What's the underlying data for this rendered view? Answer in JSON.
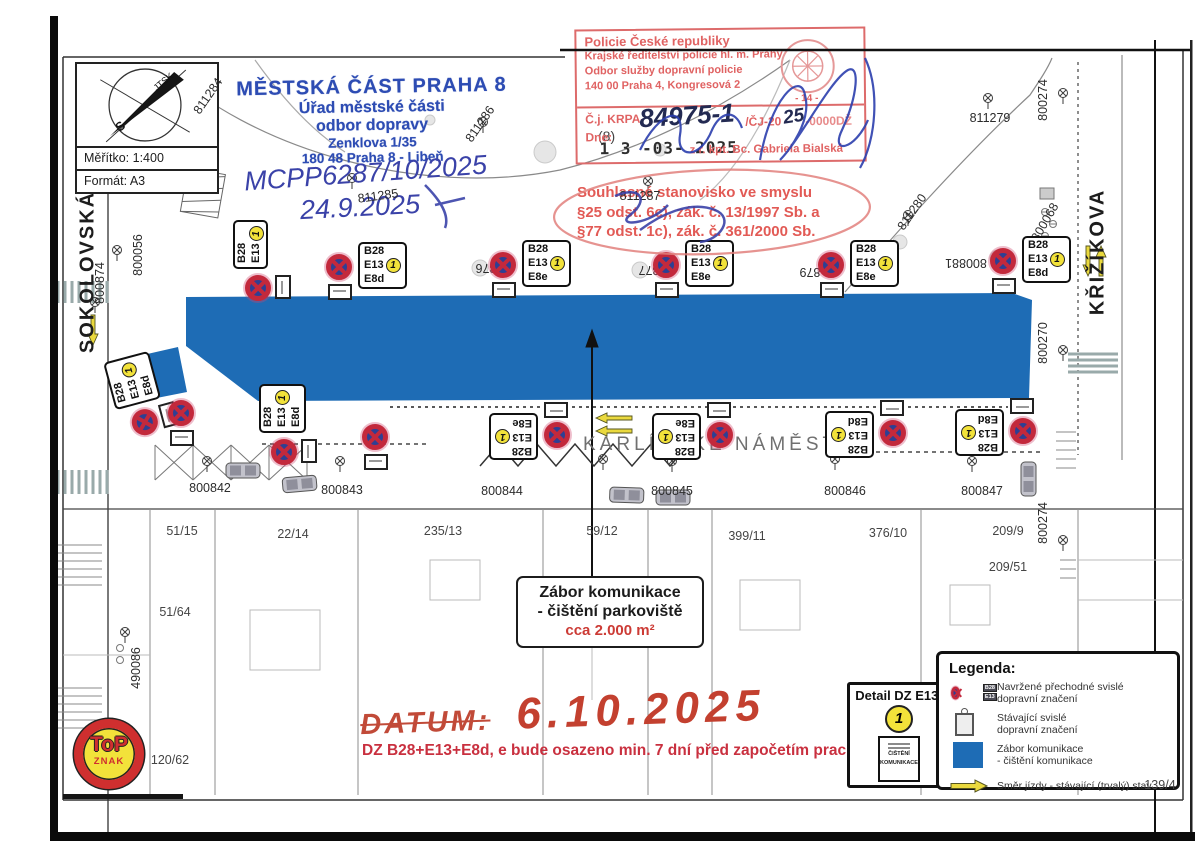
{
  "title_block": {
    "scale_label": "Měřítko: 1:400",
    "format_label": "Formát: A3",
    "compass_s": "S",
    "compass_jtsk": "JTSK"
  },
  "authority_stamp": {
    "l1": "MĚSTSKÁ ČÁST PRAHA 8",
    "l2": "Úřad městské části",
    "l3": "odbor dopravy",
    "l4": "Zenklova 1/35",
    "l5": "180 48 Praha 8 - Libeň",
    "aside": "(8)"
  },
  "handwriting_blue": {
    "l1": "MCPP6287/10/2025",
    "l2": "24.9.2025"
  },
  "police_stamp": {
    "l1": "Policie České republiky",
    "l2": "Krajské ředitelství policie hl. m. Prahy",
    "l3": "Odbor služby dopravní policie",
    "l4": "140 00 Praha 4, Kongresová 2",
    "emblem_num": "- 14 -",
    "cj_prefix": "Č.j. KRPA-",
    "cj_hand": "84975-1",
    "cj_mid": "/ČJ-20",
    "cj_hand2": "25",
    "cj_suffix": "-0000DŽ",
    "dne_label": "Dne:",
    "date_stamp": "1 3 -03- 2025",
    "signer": "z r. kpt. Bc. Gabriela Bialská"
  },
  "approval_note": {
    "l1": "Souhlasné stanovisko ve smyslu",
    "l2": "§25 odst. 6c), zák. č. 13/1997 Sb. a",
    "l3": "§77 odst. 1c), zák. č. 361/2000 Sb."
  },
  "streets": {
    "left": "SOKOLOVSKÁ",
    "right": "KŘIŽÍKOVA",
    "center": "KARLÍNSKÉ NÁMĚSTÍ"
  },
  "zabor_box": {
    "l1": "Zábor komunikace",
    "l2": "- čištění parkoviště",
    "l3": "cca 2.000 m²"
  },
  "handwriting_red": {
    "datum": "DATUM:",
    "date": "6.10.2025"
  },
  "note_red": "DZ B28+E13+E8d, e bude osazeno min. 7 dní před započetím prací!",
  "detail_box": {
    "title": "Detail DZ E13:",
    "badge": "1",
    "sign_lines": [
      "ČIŠTĚNÍ",
      "KOMUNIKACE"
    ]
  },
  "legend": {
    "title": "Legenda:",
    "chips": [
      "B28",
      "E13"
    ],
    "row1": [
      "Navržené přechodné svislé",
      "dopravní značení"
    ],
    "row2": [
      "Stávající svislé",
      "dopravní značení"
    ],
    "row3": [
      "Zábor komunikace",
      "- čištění komunikace"
    ],
    "row4": [
      "Směr jízdy - stávající (trvalý) stav"
    ]
  },
  "logo": {
    "top": "ToP",
    "znak": "ZNAK"
  },
  "colors": {
    "zone_blue": "#1e6cb5",
    "ink_blue": "#2d4cb3",
    "stamp_red": "#e06363",
    "sign_ring": "#c3293c",
    "sign_fill": "#2e3f93",
    "badge_yellow": "#f2e23a",
    "note_red": "#c9303f"
  },
  "map": {
    "lamps": [
      {
        "x": 213,
        "y": 110
      },
      {
        "x": 352,
        "y": 178
      },
      {
        "x": 483,
        "y": 122
      },
      {
        "x": 648,
        "y": 181
      },
      {
        "x": 908,
        "y": 215
      },
      {
        "x": 988,
        "y": 98
      },
      {
        "x": 117,
        "y": 250
      },
      {
        "x": 95,
        "y": 302
      },
      {
        "x": 1063,
        "y": 93
      },
      {
        "x": 1063,
        "y": 350
      },
      {
        "x": 1063,
        "y": 540
      },
      {
        "x": 207,
        "y": 461
      },
      {
        "x": 340,
        "y": 461
      },
      {
        "x": 603,
        "y": 459
      },
      {
        "x": 672,
        "y": 461
      },
      {
        "x": 835,
        "y": 459
      },
      {
        "x": 972,
        "y": 461
      },
      {
        "x": 125,
        "y": 632
      }
    ],
    "labels": [
      {
        "t": "811279",
        "x": 990,
        "y": 118,
        "rot": 0
      },
      {
        "t": "811287",
        "x": 640,
        "y": 196,
        "rot": 0
      },
      {
        "t": "811284",
        "x": 208,
        "y": 96,
        "rot": -55
      },
      {
        "t": "811286",
        "x": 480,
        "y": 124,
        "rot": -55
      },
      {
        "t": "811280",
        "x": 912,
        "y": 212,
        "rot": -55
      },
      {
        "t": "811285",
        "x": 378,
        "y": 196,
        "rot": -8
      },
      {
        "t": "800068",
        "x": 1045,
        "y": 222,
        "rot": -60
      },
      {
        "t": "800056",
        "x": 138,
        "y": 255,
        "rot": -90
      },
      {
        "t": "800874",
        "x": 100,
        "y": 283,
        "rot": -90
      },
      {
        "t": "800274",
        "x": 1043,
        "y": 100,
        "rot": -90
      },
      {
        "t": "800270",
        "x": 1043,
        "y": 343,
        "rot": -90
      },
      {
        "t": "800274",
        "x": 1043,
        "y": 523,
        "rot": -90
      },
      {
        "t": "490086",
        "x": 136,
        "y": 668,
        "rot": -90
      },
      {
        "t": "876",
        "x": 486,
        "y": 268,
        "rot": 180
      },
      {
        "t": "877",
        "x": 649,
        "y": 270,
        "rot": 180
      },
      {
        "t": "879",
        "x": 810,
        "y": 272,
        "rot": 180
      },
      {
        "t": "800881",
        "x": 966,
        "y": 263,
        "rot": 180
      },
      {
        "t": "800842",
        "x": 210,
        "y": 488,
        "rot": 0
      },
      {
        "t": "800843",
        "x": 342,
        "y": 490,
        "rot": 0
      },
      {
        "t": "800844",
        "x": 502,
        "y": 491,
        "rot": 0
      },
      {
        "t": "800845",
        "x": 672,
        "y": 491,
        "rot": 0
      },
      {
        "t": "800846",
        "x": 845,
        "y": 491,
        "rot": 0
      },
      {
        "t": "800847",
        "x": 982,
        "y": 491,
        "rot": 0
      }
    ],
    "parcels": [
      {
        "t": "51/15",
        "x": 182,
        "y": 531
      },
      {
        "t": "22/14",
        "x": 293,
        "y": 534
      },
      {
        "t": "235/13",
        "x": 443,
        "y": 531
      },
      {
        "t": "59/12",
        "x": 602,
        "y": 531
      },
      {
        "t": "399/11",
        "x": 747,
        "y": 536
      },
      {
        "t": "376/10",
        "x": 888,
        "y": 533
      },
      {
        "t": "209/9",
        "x": 1008,
        "y": 531
      },
      {
        "t": "209/51",
        "x": 1008,
        "y": 567
      },
      {
        "t": "51/64",
        "x": 175,
        "y": 612
      },
      {
        "t": "120/62",
        "x": 170,
        "y": 760
      },
      {
        "t": "139/4",
        "x": 1160,
        "y": 785
      }
    ],
    "temp_signs": [
      {
        "x": 326,
        "y": 244,
        "rot": 0,
        "lines": [
          "B28",
          "E13",
          "E8d"
        ]
      },
      {
        "x": 490,
        "y": 242,
        "rot": 0,
        "lines": [
          "B28",
          "E13",
          "E8e"
        ]
      },
      {
        "x": 653,
        "y": 242,
        "rot": 0,
        "lines": [
          "B28",
          "E13",
          "E8e"
        ]
      },
      {
        "x": 818,
        "y": 242,
        "rot": 0,
        "lines": [
          "B28",
          "E13",
          "E8e"
        ]
      },
      {
        "x": 990,
        "y": 238,
        "rot": 0,
        "lines": [
          "B28",
          "E13",
          "E8d"
        ]
      },
      {
        "x": 462,
        "y": 400,
        "rot": 180,
        "lines": [
          "B28",
          "E13",
          "E8e"
        ]
      },
      {
        "x": 625,
        "y": 400,
        "rot": 180,
        "lines": [
          "B28",
          "E13",
          "E8e"
        ]
      },
      {
        "x": 798,
        "y": 398,
        "rot": 180,
        "lines": [
          "B28",
          "E13",
          "E8d"
        ]
      },
      {
        "x": 928,
        "y": 396,
        "rot": 180,
        "lines": [
          "B28",
          "E13",
          "E8d"
        ]
      },
      {
        "x": 86,
        "y": 352,
        "rot": -105,
        "lines": [
          "B28",
          "E13",
          "E8d"
        ]
      },
      {
        "x": 236,
        "y": 382,
        "rot": -90,
        "lines": [
          "B28",
          "E13",
          "E8d"
        ]
      },
      {
        "x": 210,
        "y": 218,
        "rot": -90,
        "lines": [
          "B28",
          "E13"
        ]
      }
    ],
    "lone_circles": [
      {
        "x": 362,
        "y": 414
      },
      {
        "x": 168,
        "y": 390
      }
    ],
    "arrows": [
      {
        "x": 88,
        "y": 315,
        "dir": "down"
      },
      {
        "x": 596,
        "y": 413,
        "dir": "left"
      },
      {
        "x": 596,
        "y": 426,
        "dir": "left"
      },
      {
        "x": 1083,
        "y": 246,
        "dir": "down"
      },
      {
        "x": 1096,
        "y": 246,
        "dir": "up"
      }
    ],
    "cars": [
      {
        "x": 282,
        "y": 478,
        "rot": -5
      },
      {
        "x": 610,
        "y": 487,
        "rot": 2
      },
      {
        "x": 656,
        "y": 490,
        "rot": 0
      },
      {
        "x": 1036,
        "y": 462,
        "rot": 90
      },
      {
        "x": 226,
        "y": 463,
        "rot": 0
      }
    ]
  }
}
